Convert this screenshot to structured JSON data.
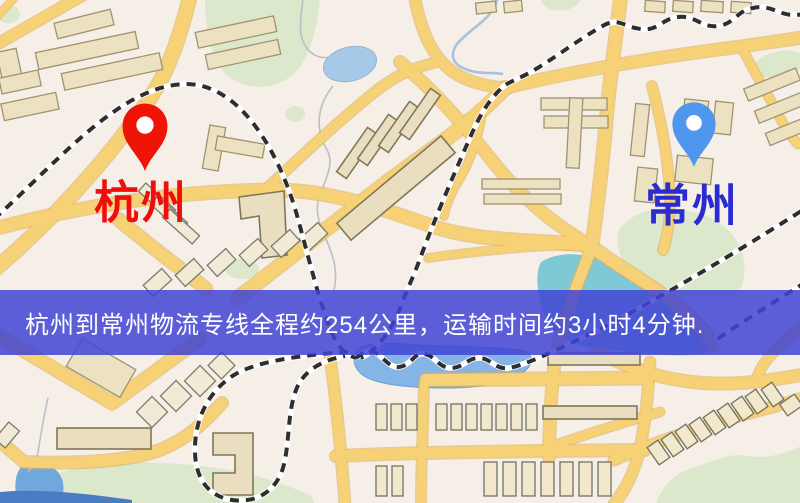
{
  "banner": {
    "text": "杭州到常州物流专线全程约254公里，运输时间约3小时4分钟.",
    "distance_km": "254",
    "duration_text": "3小时4分钟",
    "background_color": "#4144d3",
    "text_color": "#ffffff"
  },
  "markers": {
    "origin": {
      "label": "杭州",
      "pin": "red-map-pin",
      "pin_color": "#ee1506",
      "label_color": "#f20d0d"
    },
    "destination": {
      "label": "常州",
      "pin": "blue-map-pin",
      "pin_color": "#4f97ee",
      "label_color": "#2b2bd2"
    }
  },
  "map_colors": {
    "background": "#f6efe8",
    "road": "#f6d175",
    "park": "#dce8cb",
    "water": "#85b4e6",
    "railway": "#2e2e2e",
    "building": "#ece1c1"
  }
}
